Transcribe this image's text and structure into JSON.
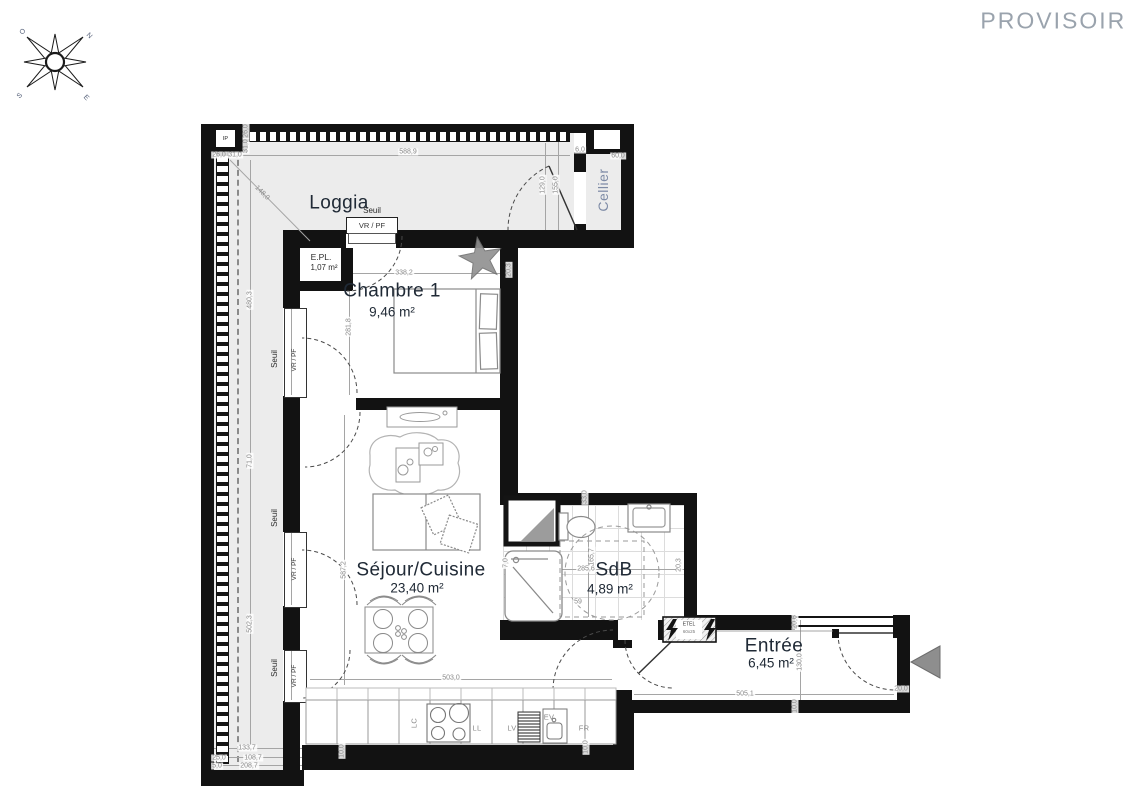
{
  "watermark": "PROVISOIRE",
  "compass": {
    "north": "N",
    "west": "O",
    "south": "S",
    "east": "E"
  },
  "rooms": {
    "loggia": {
      "name": "Loggia"
    },
    "cellier": {
      "name": "Cellier"
    },
    "chambre": {
      "name": "Chambre 1",
      "area": "9,46 m²"
    },
    "epl": {
      "name": "E.PL.",
      "area": "1,07 m²"
    },
    "sejour": {
      "name": "Séjour/Cuisine",
      "area": "23,40 m²"
    },
    "sdb": {
      "name": "SdB",
      "area": "4,89 m²"
    },
    "entree": {
      "name": "Entrée",
      "area": "6,45 m²"
    }
  },
  "annotations": {
    "seuil_top": "Seuil",
    "vrpf_top": "VR / PF",
    "seuil_1": "Seuil",
    "vrpf_1": "VR / PF",
    "seuil_2": "Seuil",
    "vrpf_2": "VR / PF",
    "seuil_3": "Seuil",
    "vrpf_3": "VR / PF",
    "etel_line1": "ETEL",
    "etel_line2": "60x25",
    "ip": "IP"
  },
  "appliances": {
    "lc": "LC",
    "ll": "LL",
    "lv": "LV",
    "ev": "EV",
    "fr": "FR"
  },
  "dims": [
    {
      "t": "588,9"
    },
    {
      "t": "129,0"
    },
    {
      "t": "155,0"
    },
    {
      "t": "26,0"
    },
    {
      "t": "31,0"
    },
    {
      "t": "31,0"
    },
    {
      "t": "26,0"
    },
    {
      "t": "148,0"
    },
    {
      "t": "6,0"
    },
    {
      "t": "60,0"
    },
    {
      "t": "480,3"
    },
    {
      "t": "71,0"
    },
    {
      "t": "502,3"
    },
    {
      "t": "133,7"
    },
    {
      "t": "25,0"
    },
    {
      "t": "108,7"
    },
    {
      "t": "5,0"
    },
    {
      "t": "208,7"
    },
    {
      "t": "338,2"
    },
    {
      "t": "20,3"
    },
    {
      "t": "281,8"
    },
    {
      "t": "587,2"
    },
    {
      "t": "7,0"
    },
    {
      "t": "503,0"
    },
    {
      "t": "33,0"
    },
    {
      "t": "165,7"
    },
    {
      "t": "285,6"
    },
    {
      "t": "59"
    },
    {
      "t": "20,3"
    },
    {
      "t": "20,6"
    },
    {
      "t": "130,0"
    },
    {
      "t": "10,0"
    },
    {
      "t": "505,1"
    },
    {
      "t": "20,0"
    },
    {
      "t": "10,0"
    },
    {
      "t": "10,0"
    }
  ]
}
